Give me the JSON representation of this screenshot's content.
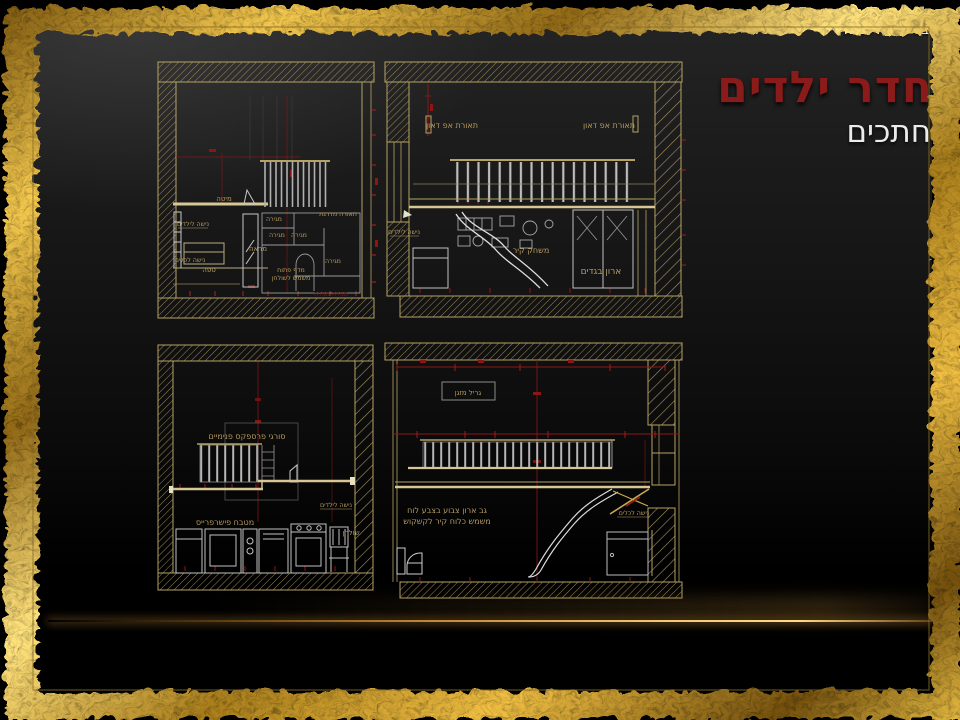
{
  "slide": {
    "blessing": "בסיעתא דשמיא",
    "title": "חדר ילדים",
    "subtitle": "חתכים"
  },
  "colors": {
    "title_red": "#8a1b1b",
    "frame_gold": "#d9b84e",
    "cad_gold": "#b5a264",
    "dimension_red": "#8c1616",
    "label_tan": "#b49a5f"
  },
  "panels": {
    "top_left": {
      "labels": {
        "bed": "מיטה",
        "kids_niche": "נישה לילדים",
        "mirror": "מראה",
        "sofa": "ספה",
        "small_niche": "נישה לכלים",
        "stepped_light": "תאורה מדרגת",
        "drawer1": "מגירה",
        "drawer2": "מגירה",
        "drawer3": "מגירה",
        "drawer4": "מגירה",
        "open_shelf_line1": "מדף פתוח",
        "open_shelf_line2": "משמש לשולחן",
        "drawers_red": "מגירה מגירה"
      }
    },
    "top_right": {
      "labels": {
        "updown_light_left": "תאורת אפ דאון",
        "updown_light_right": "תאורת אפ דאון",
        "kids_niche": "נישה לילדים",
        "wall_game": "משחק קיר",
        "wardrobe": "ארון בגדים"
      }
    },
    "bottom_left": {
      "labels": {
        "perspex_bars": "סורגי פרספקס פנימיים",
        "kids_niche": "נישה לילדים",
        "kitchen": "מטבח פישרפרייס",
        "table": "שולחן"
      }
    },
    "bottom_right": {
      "labels": {
        "ac_grill": "גריל מזגן",
        "board_line1": "גב ארון צבוע בצבע לוח",
        "board_line2": "משמש כלוח קיר לקשקוש",
        "tools_niche": "נישה לכלים"
      }
    }
  }
}
